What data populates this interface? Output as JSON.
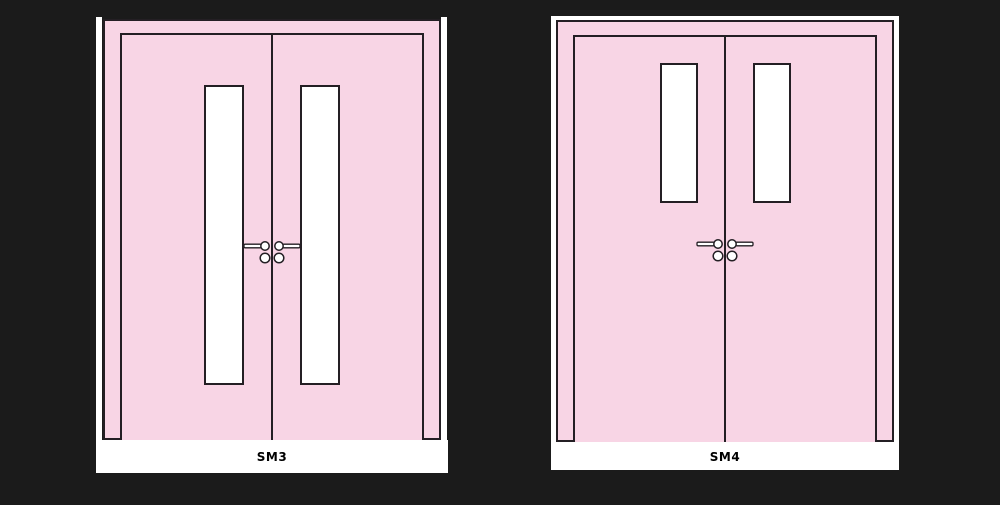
{
  "colors": {
    "background": "#1b1b1b",
    "door": "#f8d5e5",
    "line": "#241f24",
    "glass": "#ffffff",
    "label_text": "#000000"
  },
  "figures": [
    {
      "label": "SM3"
    },
    {
      "label": "SM4"
    }
  ]
}
